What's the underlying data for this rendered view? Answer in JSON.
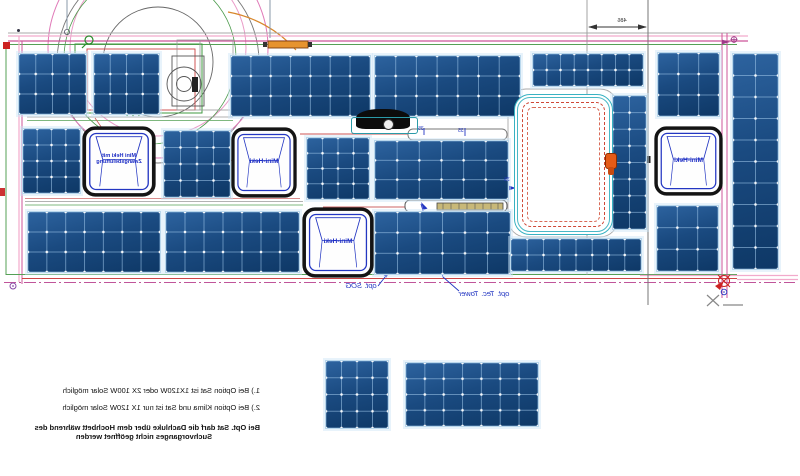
{
  "notes": {
    "line1": "1.) Bei Option Sat ist 1X120W oder 2X 100W Solar möglich",
    "line2": "2.) Bei Option Klima und Sat ist nur 1X 120W Solar möglich",
    "line3": "Bei Opt. Sat darf die Dachluke über dem Hochbett während des",
    "line4": "Suchvorganges nicht geöffnet werden"
  },
  "labels": {
    "sog": "opt. SOG",
    "tec_tower": "opt. Tec. Tower",
    "dim_top": "486",
    "dim_small": "35"
  },
  "colors": {
    "panel_blue": "#16406f",
    "panel_grid": "#a0c8eb",
    "accent_blue": "#2336c2",
    "roof_green": "#3f9a3f",
    "roof_red": "#cc4444",
    "outline_pink": "#f0a8cc",
    "centerline_magenta": "#c0549a",
    "skylight_teal": "#38b2c2",
    "orange": "#e6932e"
  },
  "drawing": {
    "mirrored": true,
    "panels": [
      {
        "x": 18,
        "y": 53,
        "w": 67,
        "h": 60,
        "cols": 4,
        "rows": 3
      },
      {
        "x": 93,
        "y": 53,
        "w": 65,
        "h": 60,
        "cols": 4,
        "rows": 3
      },
      {
        "x": 230,
        "y": 55,
        "w": 139,
        "h": 60,
        "cols": 7,
        "rows": 3
      },
      {
        "x": 374,
        "y": 55,
        "w": 145,
        "h": 60,
        "cols": 7,
        "rows": 3
      },
      {
        "x": 532,
        "y": 53,
        "w": 110,
        "h": 32,
        "cols": 8,
        "rows": 2
      },
      {
        "x": 657,
        "y": 52,
        "w": 61,
        "h": 63,
        "cols": 3,
        "rows": 3
      },
      {
        "x": 732,
        "y": 53,
        "w": 45,
        "h": 215,
        "cols": 2,
        "rows": 10
      },
      {
        "x": 22,
        "y": 128,
        "w": 57,
        "h": 64,
        "cols": 4,
        "rows": 4
      },
      {
        "x": 163,
        "y": 130,
        "w": 66,
        "h": 66,
        "cols": 4,
        "rows": 4
      },
      {
        "x": 306,
        "y": 137,
        "w": 62,
        "h": 61,
        "cols": 4,
        "rows": 4
      },
      {
        "x": 374,
        "y": 140,
        "w": 133,
        "h": 58,
        "cols": 6,
        "rows": 3
      },
      {
        "x": 612,
        "y": 95,
        "w": 33,
        "h": 133,
        "cols": 2,
        "rows": 8
      },
      {
        "x": 27,
        "y": 211,
        "w": 132,
        "h": 60,
        "cols": 7,
        "rows": 3
      },
      {
        "x": 165,
        "y": 211,
        "w": 133,
        "h": 60,
        "cols": 7,
        "rows": 3
      },
      {
        "x": 374,
        "y": 211,
        "w": 135,
        "h": 62,
        "cols": 6,
        "rows": 3
      },
      {
        "x": 510,
        "y": 238,
        "w": 130,
        "h": 32,
        "cols": 8,
        "rows": 2
      },
      {
        "x": 656,
        "y": 205,
        "w": 61,
        "h": 65,
        "cols": 3,
        "rows": 3
      },
      {
        "x": 325,
        "y": 360,
        "w": 62,
        "h": 67,
        "cols": 4,
        "rows": 4
      },
      {
        "x": 405,
        "y": 362,
        "w": 132,
        "h": 63,
        "cols": 7,
        "rows": 4
      }
    ],
    "hatches": [
      {
        "x": 82,
        "y": 126,
        "w": 74,
        "h": 71,
        "lines": [
          "Mini Heki mit",
          "Zwangsbelüftung"
        ]
      },
      {
        "x": 231,
        "y": 127,
        "w": 66,
        "h": 71,
        "lines": [
          "Mini-Heki"
        ]
      },
      {
        "x": 302,
        "y": 207,
        "w": 72,
        "h": 71,
        "lines": [
          "Mini-Heki"
        ]
      },
      {
        "x": 654,
        "y": 126,
        "w": 69,
        "h": 70,
        "lines": [
          "Mini-Heki"
        ]
      }
    ]
  }
}
